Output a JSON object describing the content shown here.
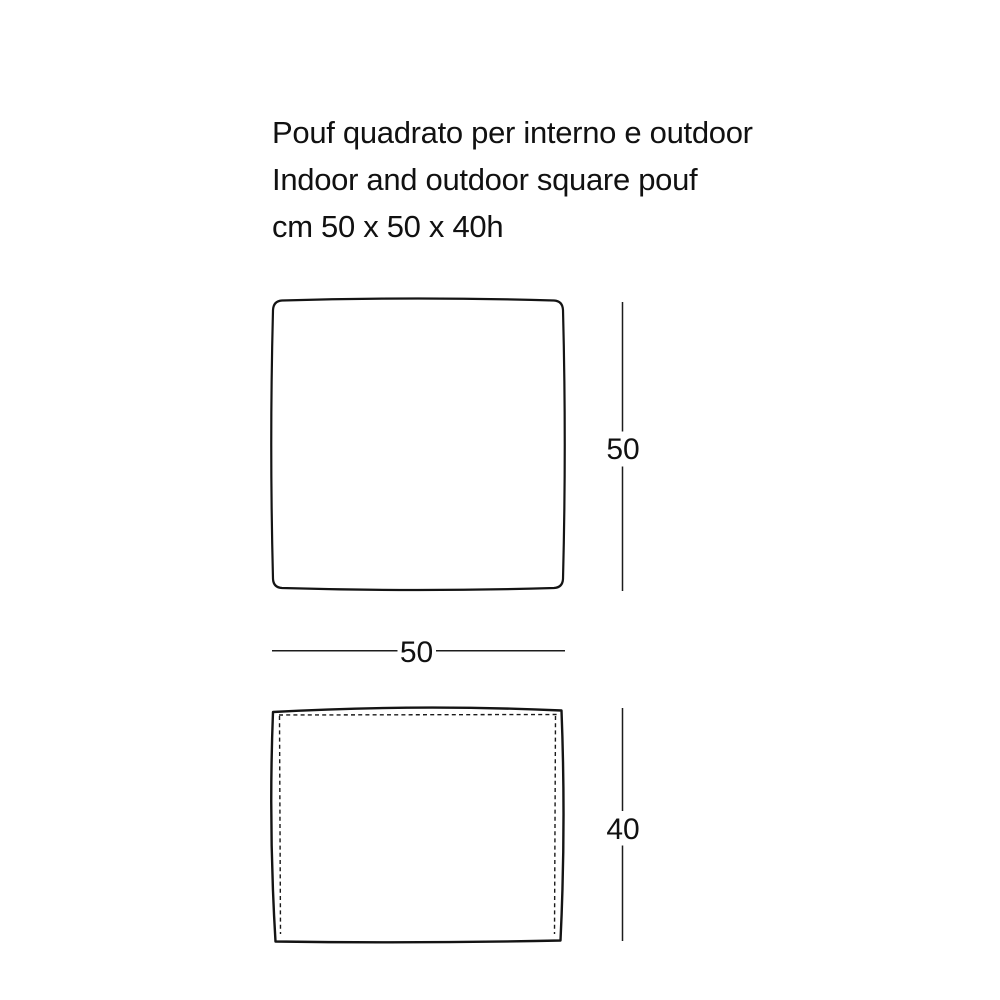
{
  "page": {
    "background": "#ffffff",
    "line_color": "#141414",
    "text_color": "#111111"
  },
  "title": {
    "line1": "Pouf quadrato per interno e outdoor",
    "line2": "Indoor and outdoor square pouf",
    "line3": "cm 50 x 50 x 40h"
  },
  "dimensions": {
    "top_view_depth": {
      "value": "50",
      "orientation": "vertical"
    },
    "width": {
      "value": "50",
      "orientation": "horizontal"
    },
    "front_view_height": {
      "value": "40",
      "orientation": "vertical"
    }
  }
}
